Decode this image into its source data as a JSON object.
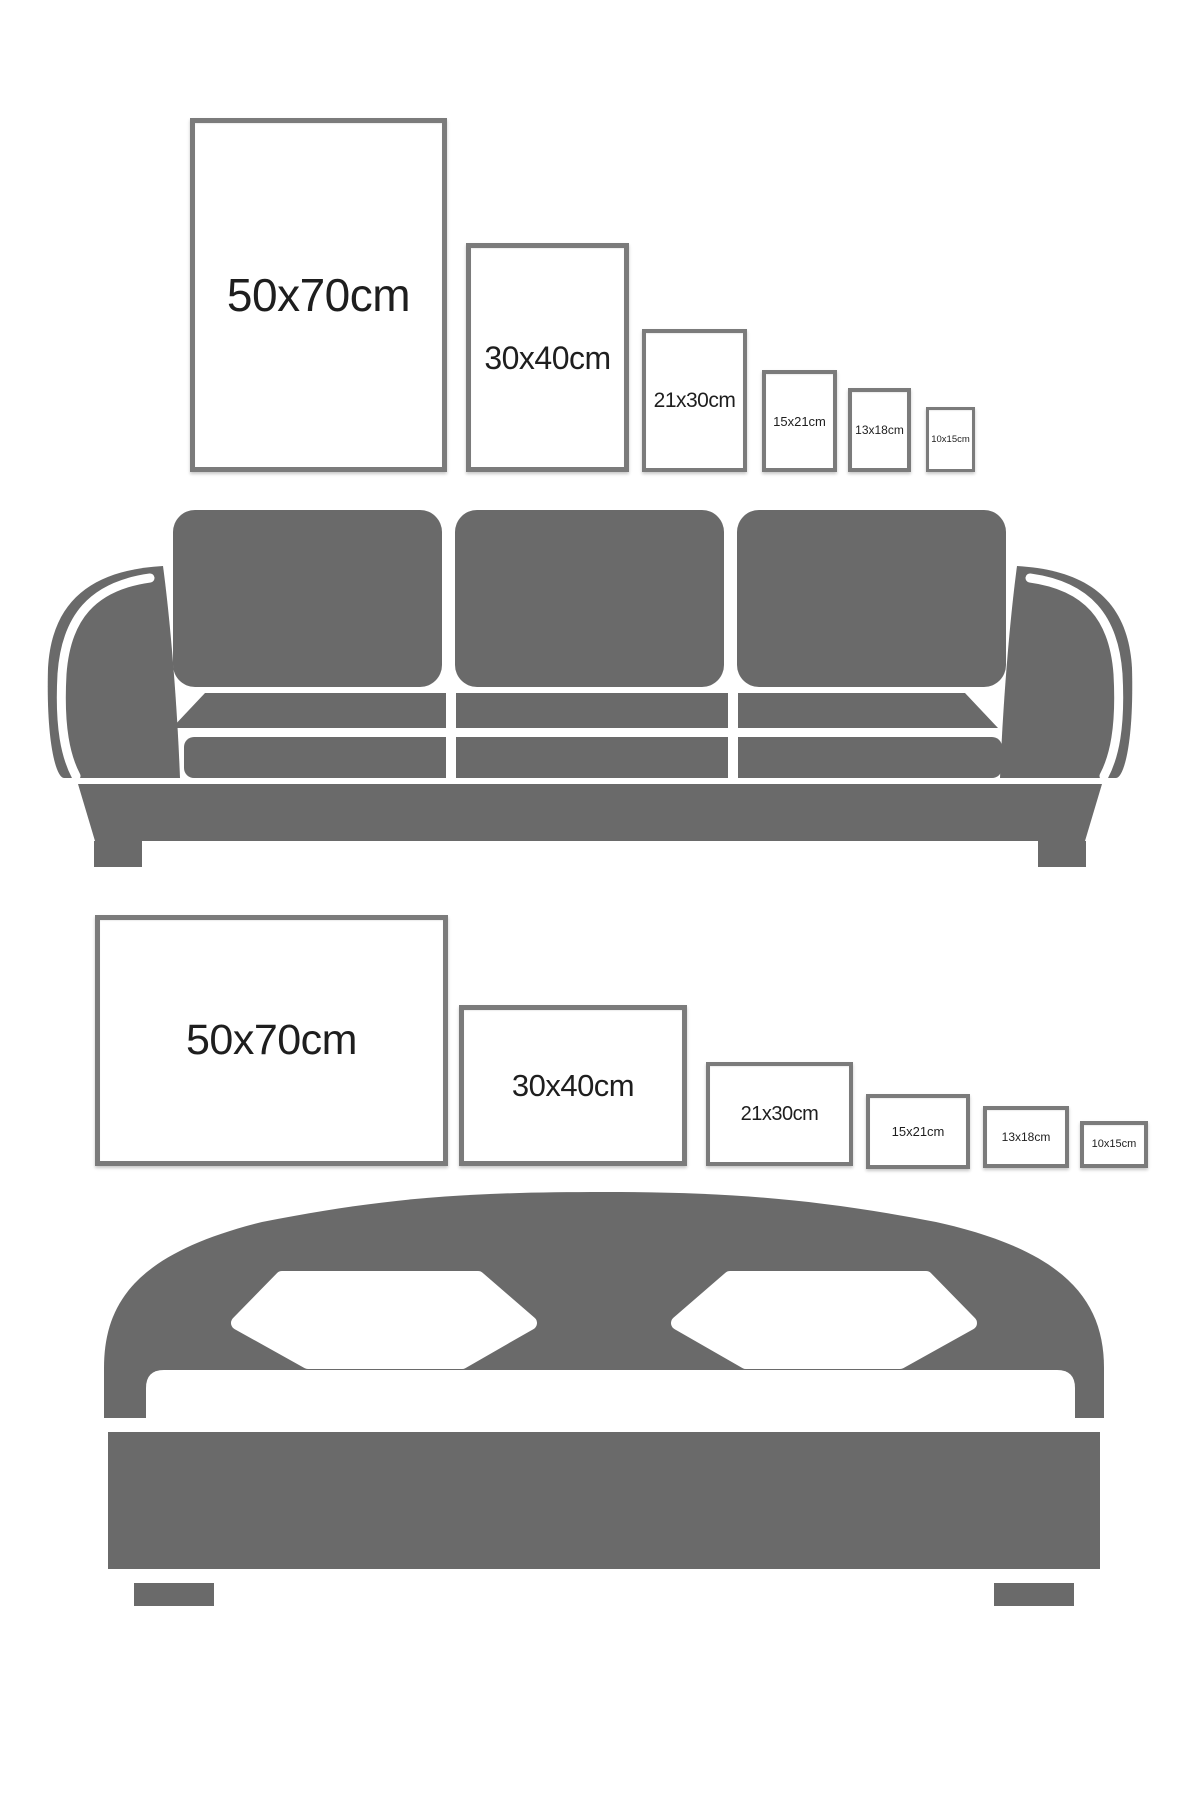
{
  "page": {
    "background": "#ffffff",
    "description_of_image": "Poster size comparison guide: portrait frames above a sofa, landscape frames above a bed"
  },
  "colors": {
    "furniture_gray": "#6a6a6a",
    "frame_border_gray": "#7b7b7b",
    "label_text": "#1e1e1e"
  },
  "sofa_section": {
    "furniture": "sofa",
    "orientation": "portrait",
    "frames": [
      {
        "label": "50x70cm"
      },
      {
        "label": "30x40cm"
      },
      {
        "label": "21x30cm"
      },
      {
        "label": "15x21cm"
      },
      {
        "label": "13x18cm"
      },
      {
        "label": "10x15cm"
      }
    ]
  },
  "bed_section": {
    "furniture": "bed",
    "orientation": "landscape",
    "frames": [
      {
        "label": "50x70cm"
      },
      {
        "label": "30x40cm"
      },
      {
        "label": "21x30cm"
      },
      {
        "label": "15x21cm"
      },
      {
        "label": "13x18cm"
      },
      {
        "label": "10x15cm"
      }
    ]
  }
}
